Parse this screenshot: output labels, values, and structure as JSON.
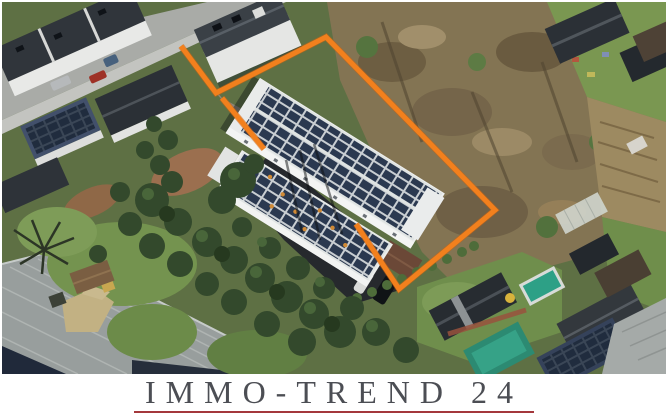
{
  "branding": {
    "logo_text": "IMMO-TREND 24",
    "logo_text_color": "#4c4e54",
    "underline_color": "#a4383c",
    "banner_background": "#ffffff"
  },
  "annotation": {
    "outline_color": "#f2801d",
    "outline_main_points": "179,44 214,91 324,35 493,208 397,287 354,222",
    "outline_driveway_points": "220,96 262,147"
  },
  "scene": {
    "description": "Oblique aerial photo of a residential block: street with parked cars and gabled houses at top left, two long white buildings with rooftop solar arrays in the centre outlined in orange, leafless woodland to the right, allotment gardens and pools at lower right, large grey warehouse roof at lower left.",
    "features": [
      "street-with-parked-cars",
      "gabled-houses",
      "solar-panel-buildings",
      "orange-property-boundary",
      "woodland",
      "allotment-gardens",
      "swimming-pool",
      "warehouse-roof",
      "garden-trees"
    ]
  }
}
